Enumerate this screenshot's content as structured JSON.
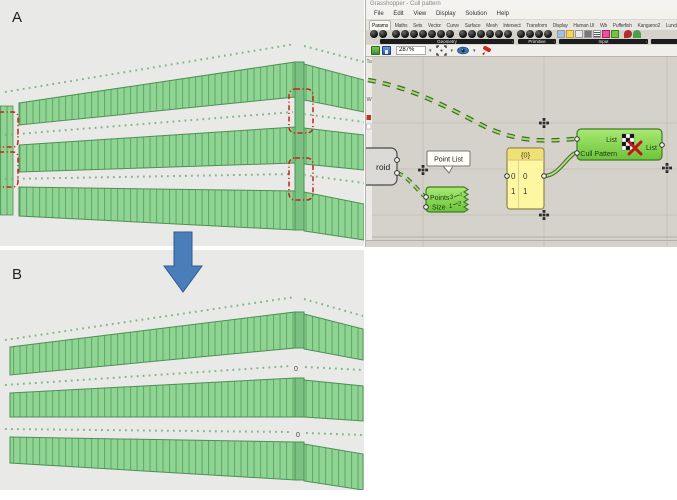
{
  "panel_a": {
    "label": "A"
  },
  "panel_b": {
    "label": "B",
    "point_index_labels": [
      "0",
      "0"
    ]
  },
  "arrow": {
    "direction": "down",
    "color": "#4a7ebb"
  },
  "grasshopper": {
    "window_title": "Grasshopper - Cull pattern",
    "menus": [
      "File",
      "Edit",
      "View",
      "Display",
      "Solution",
      "Help"
    ],
    "tabs": [
      "Params",
      "Maths",
      "Sets",
      "Vector",
      "Curve",
      "Surface",
      "Mesh",
      "Intersect",
      "Transform",
      "Display",
      "Human UI",
      "Wb",
      "Pufferfish",
      "Kangaroo2",
      "LunchBox",
      "Elefront"
    ],
    "active_tab": "Params",
    "toolbar_groups": [
      "Geometry",
      "Primitive",
      "Input"
    ],
    "status": {
      "zoom_value": "287%"
    },
    "canvas": {
      "clipped_component_label": "roid",
      "edge_labels": [
        "Ta",
        "W"
      ],
      "tooltip_label": "Point List",
      "point_list_component": {
        "inputs": [
          "Points",
          "Size"
        ],
        "icon_digits": [
          "3",
          "4",
          "1",
          "2"
        ]
      },
      "panel_component": {
        "header": "{0}",
        "rows": [
          {
            "index": "0",
            "value": "0"
          },
          {
            "index": "1",
            "value": "1"
          }
        ]
      },
      "cull_pattern_component": {
        "inputs": [
          "List",
          "Cull Pattern"
        ],
        "output": "List"
      }
    },
    "colors": {
      "canvas_bg": "#d5d2cb",
      "component_green": "#84d94e",
      "panel_yellow": "#fdf7a2",
      "wire_green": "#76b041"
    }
  },
  "viewport_colors": {
    "background": "#e9e9e7",
    "band_green": "#8fd492",
    "band_stripe": "#62ab6b",
    "corner_green": "#7cc184",
    "dot_green": "#7fb885",
    "highlight_red": "#c3251c"
  }
}
